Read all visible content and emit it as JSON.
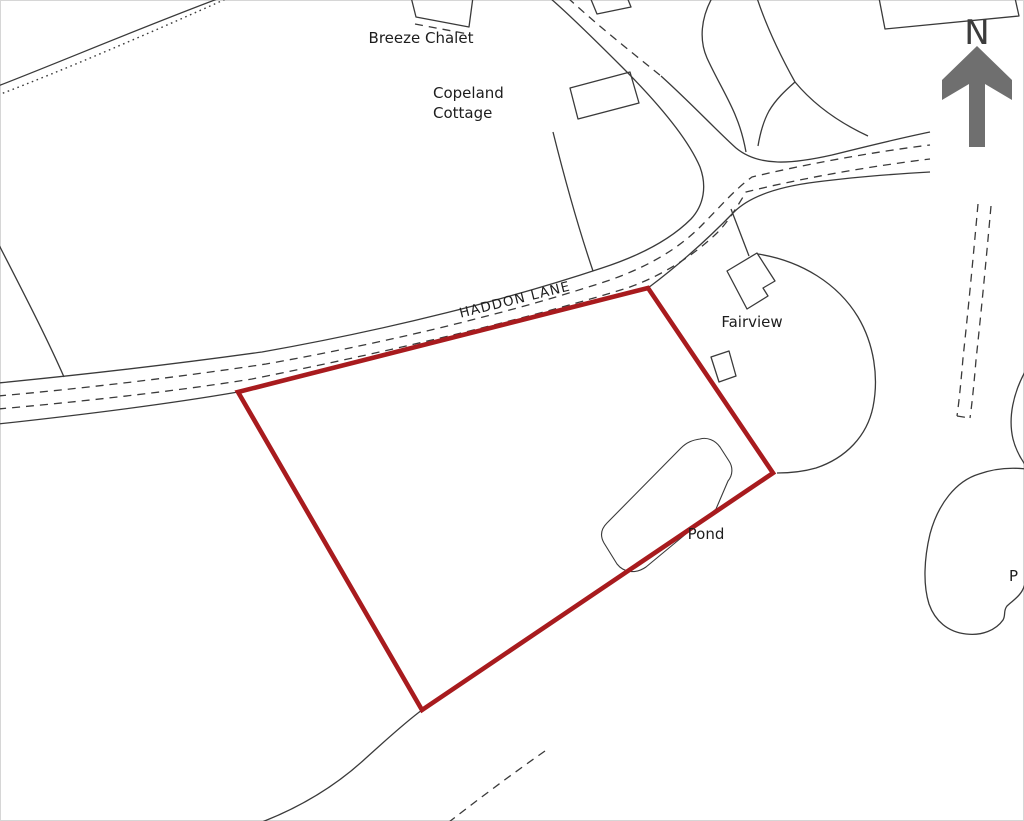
{
  "labels": {
    "breeze_chalet": "Breeze Chalet",
    "copeland_line1": "Copeland",
    "copeland_line2": "Cottage",
    "haddon_lane": "HADDON LANE",
    "fairview": "Fairview",
    "pond": "Pond",
    "pond_clipped": "P",
    "north": "N"
  },
  "colors": {
    "boundary_red": "#a81b1e",
    "map_line": "#3a3a3a",
    "label_text": "#1d1d1d",
    "north_arrow_gray": "#6f6f6f",
    "background": "#ffffff"
  }
}
